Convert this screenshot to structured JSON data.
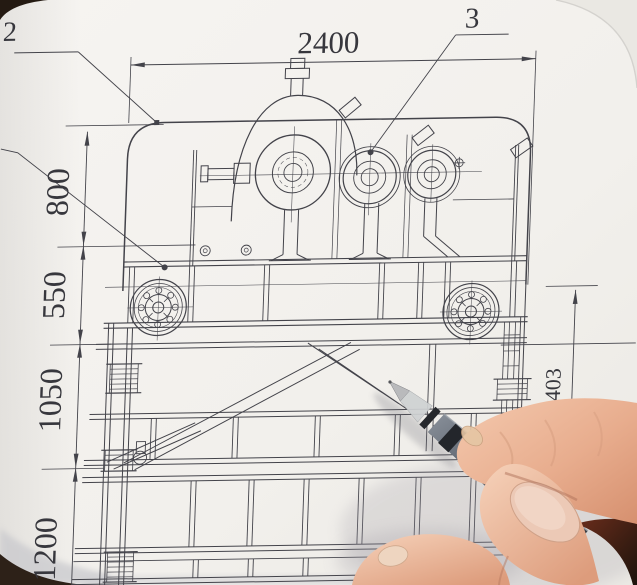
{
  "scene": {
    "description": "Photograph of a mechanical engineering drawing (machine frame with gear drive, flywheels and truss bracing) with a hand holding a pen pointing at the bracing",
    "paper_color": "#f2f0ec",
    "ink_color": "#3f3f46",
    "pen_color": "#4a505a",
    "skin_color": "#e9b395",
    "table_corner_color": "#33241a"
  },
  "labels": {
    "dim_width_top": "2400",
    "dim_left_800": "800",
    "dim_left_550": "550",
    "dim_left_1050": "1050",
    "dim_left_1200": "1200",
    "dim_right_1403": "1403",
    "callout_2": "2",
    "callout_3": "3"
  }
}
